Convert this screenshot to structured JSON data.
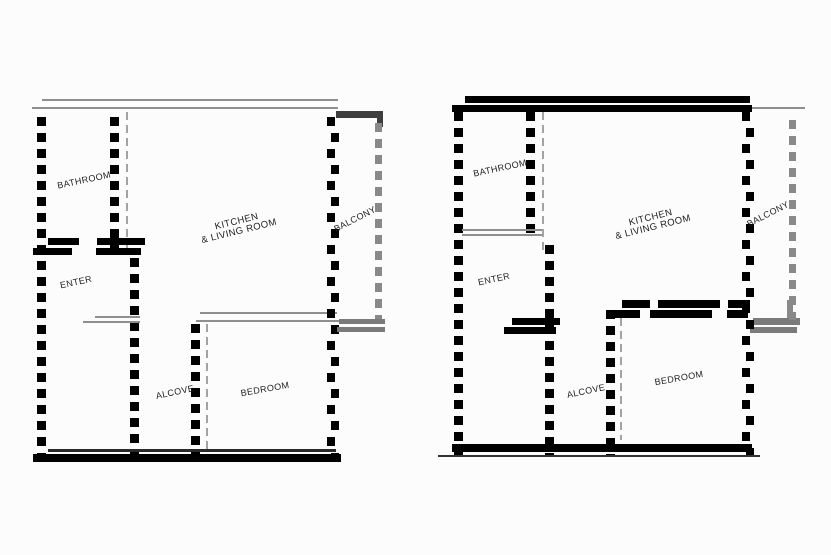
{
  "canvas": {
    "background": "#fcfcfc"
  },
  "colors": {
    "wall_black": "#000000",
    "wall_dark_gray": "#3e3e3e",
    "balcony_wall_gray": "#898989",
    "thin_line_gray": "#8f8f8f",
    "label_color": "#1d1d1d"
  },
  "plans": [
    {
      "id": "left",
      "rooms": {
        "bathroom": "BATHROOM",
        "enter": "ENTER",
        "kitchen_line1": "KITCHEN",
        "kitchen_line2": "& LIVING ROOM",
        "balcony": "BALCONY",
        "alcove": "ALCOVE",
        "bedroom": "BEDROOM"
      }
    },
    {
      "id": "right",
      "rooms": {
        "bathroom": "BATHROOM",
        "enter": "ENTER",
        "kitchen_line1": "KITCHEN",
        "kitchen_line2": "& LIVING ROOM",
        "balcony": "BALCONY",
        "alcove": "ALCOVE",
        "bedroom": "BEDROOM"
      }
    }
  ]
}
